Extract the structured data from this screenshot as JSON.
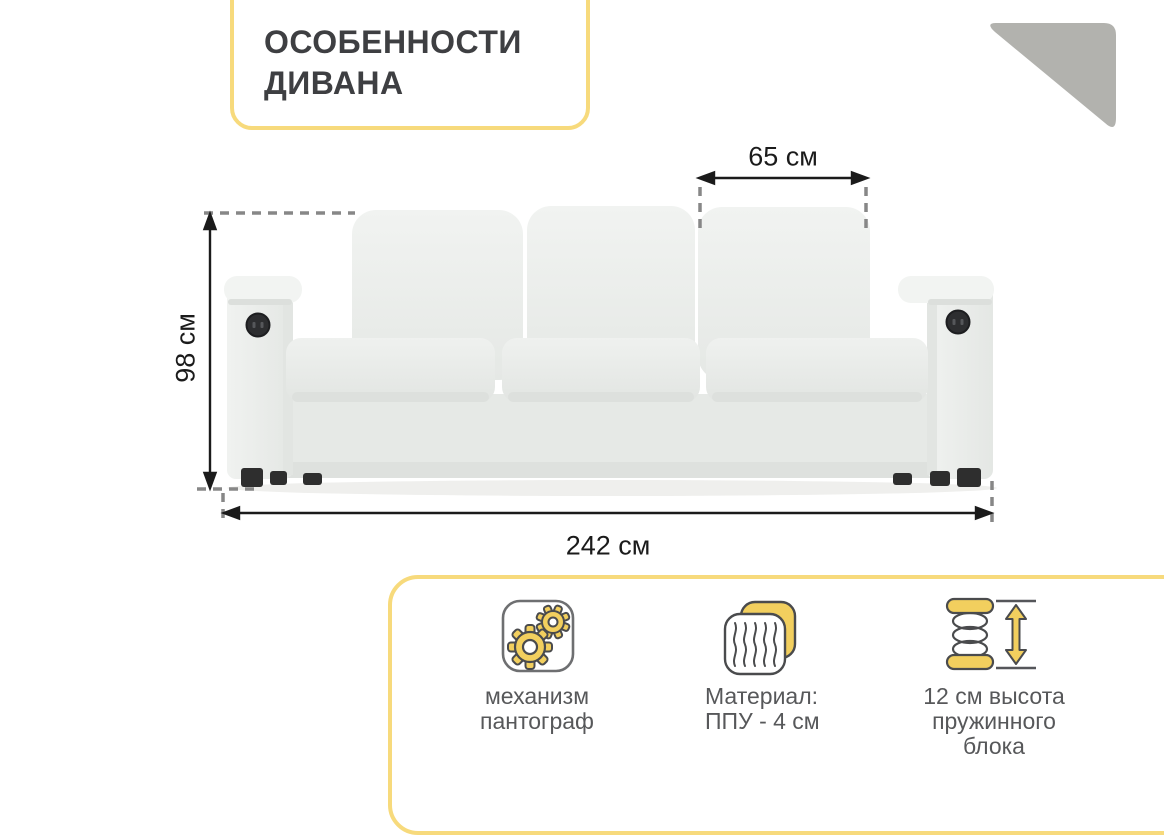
{
  "infographic": {
    "title": "ОСОБЕННОСТИ\nДИВАНА"
  },
  "sofa": {
    "description": "three-seat light-gray sofa with USB/power outlets in both armrests",
    "dimensions": {
      "cushion_width": "65 см",
      "height": "98 см",
      "total_width": "242 см"
    }
  },
  "features": {
    "items": [
      {
        "icon": "gears-icon",
        "label": "механизм\nпантограф"
      },
      {
        "icon": "foam-layers-icon",
        "label": "Материал:\nППУ - 4 см"
      },
      {
        "icon": "spring-height-icon",
        "label": "12 см высота\nпружинного\nблока"
      }
    ]
  },
  "colors": {
    "accent_yellow_border": "#f7da7c",
    "icon_yellow": "#f2cf5e",
    "icon_outline": "#4a4b4d",
    "triangle_gray": "#b2b2ae",
    "title_text": "#3e3f42",
    "feature_text": "#57585a",
    "dimension_text": "#1b1b1b",
    "sofa_fabric": "#eceeec"
  }
}
